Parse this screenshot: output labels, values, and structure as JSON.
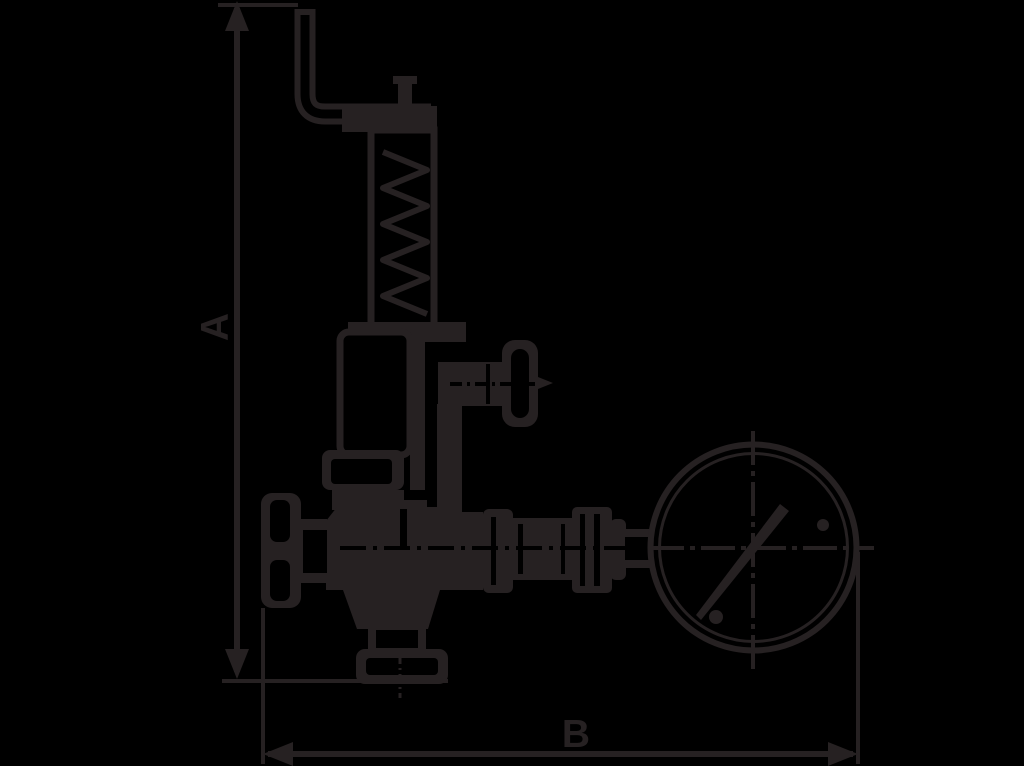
{
  "dimension_labels": {
    "vertical": "A",
    "horizontal": "B"
  },
  "colors": {
    "background": "#000000",
    "ink": "#262122",
    "paper_gap": "#000000"
  }
}
